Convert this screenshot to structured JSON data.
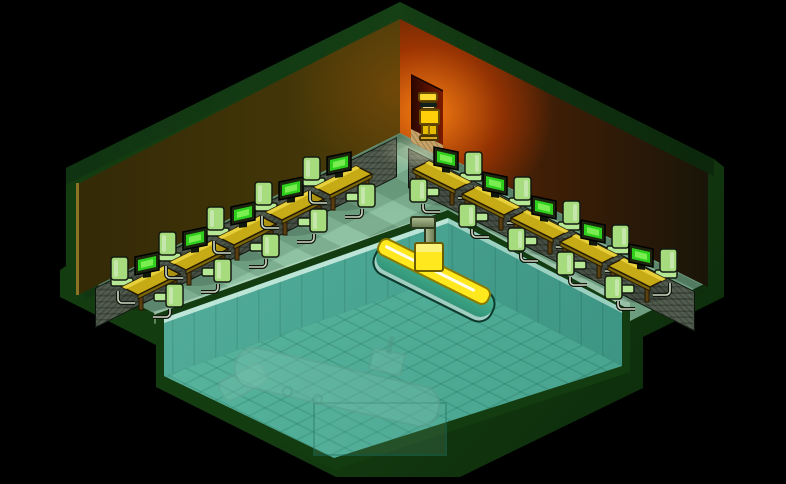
{
  "scene": {
    "description": "isometric pixel-art room with computer workstations around a sunken submarine pool, glowing doorway with character",
    "colors": {
      "bg": "#000000",
      "border-green": "#143c11",
      "cap-green": "#1b4d19",
      "wall-left": "#5a4a10",
      "wall-right-hot": "#c64300",
      "door-inner": "#7a1b00",
      "door-floor": "#c8a468",
      "floor-light": "#8fc2a3",
      "carpet": "#515c4e",
      "pool-wall": "#44988a",
      "pool-floor": "#52ab94",
      "sub-deck": "#ffe81e",
      "sub-hull": "#49b894",
      "char-hair": "#ffd92e",
      "char-suit": "#ffd00a",
      "chair-green": "#a6db7e",
      "chair-seat": "#b6e794",
      "desk-top": "#c7ab16",
      "desk-side": "#7d680a",
      "desk-leg": "#5a3f10",
      "monitor-case": "#1d260f",
      "screen-green": "#2fd01d",
      "screen-glow": "#8df55f"
    },
    "workstations": {
      "sprite_size": [
        78,
        68
      ],
      "left_row": [
        {
          "x": 108,
          "y": 251
        },
        {
          "x": 156,
          "y": 226
        },
        {
          "x": 204,
          "y": 201
        },
        {
          "x": 252,
          "y": 176
        },
        {
          "x": 300,
          "y": 151
        }
      ],
      "right_row": [
        {
          "x": 407,
          "y": 146
        },
        {
          "x": 456,
          "y": 171
        },
        {
          "x": 505,
          "y": 195
        },
        {
          "x": 554,
          "y": 219
        },
        {
          "x": 602,
          "y": 243
        }
      ]
    },
    "entities": {
      "submarine": {
        "x": 366,
        "y": 240
      },
      "ghost-submarine": {
        "x": 218,
        "y": 338
      },
      "character": {
        "x": 415,
        "y": 90
      }
    },
    "counts": {
      "workstations": 10,
      "chairs_per_workstation": 2,
      "monitors": 10
    }
  }
}
